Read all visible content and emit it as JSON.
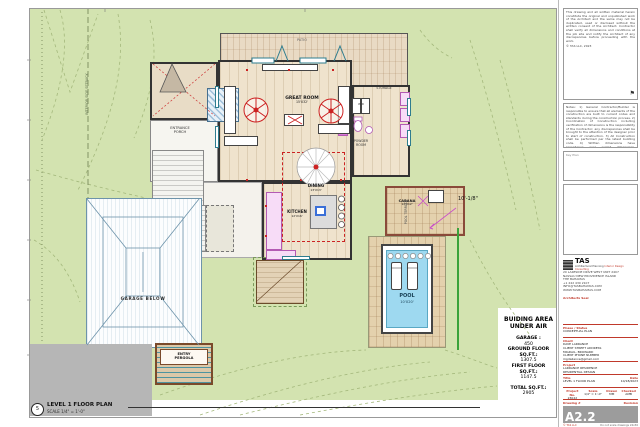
{
  "sheet_title": {
    "bubble": "5",
    "title": "LEVEL 1 FLOOR PLAN",
    "scale": "SCALE 1/4\" = 1'-0\""
  },
  "plan": {
    "patio": "PATIO",
    "great_room": "GREAT ROOM",
    "great_room_size": "15'X32'",
    "entrance_porch_1": "ENTRANCE",
    "entrance_porch_2": "PORCH",
    "dining": "DINING",
    "dining_size": "13'X13'",
    "kitchen": "KITCHEN",
    "kitchen_size": "12'X16'",
    "storage": "STORAGE",
    "wd": "W.D",
    "powder_1": "POWDER",
    "powder_2": "ROOM",
    "cabana": "CABANA",
    "cabana_size": "12'X12'",
    "pool_terrace": "POOL TERRACE",
    "pool": "POOL",
    "pool_size": "10'X20'",
    "garage_below": "GARAGE BELOW",
    "entry_pergola_1": "ENTRY",
    "entry_pergola_2": "PERGOLA",
    "setback": "INTERIOR SIDE SETBACK",
    "dim": "10'-1/8\""
  },
  "area_summary": {
    "title1": "BUIDING AREA",
    "title2": "UNDER AIR",
    "garage_label": "GARAGE :",
    "garage_value": "450",
    "ground_label": "GROUND FLOOR",
    "ground_sqft": "SQ.FT.:",
    "ground_value": "1307.5",
    "first_label": "FIRST FLOOR",
    "first_sqft": "SQ.FT.:",
    "first_value": "1147.5",
    "total_label": "TOTAL SQ.FT.:",
    "total_value": "2905"
  },
  "title_block": {
    "copyright": "This drawing and all written material herein constitute the original and unpublished work of the Architect and the same may not be duplicated, used or disclosed without the written consent of the Architect. Contractor shall verify all dimensions and conditions at the job site and notify the Architect of any discrepancies before proceeding with the work.",
    "copyright_sig": "© TAS LLC, 2023",
    "notes": "Notes:  1) General Contractor/Builder is responsible to ensure that all elements of the construction are built to current codes and standards during the construction process.  2) Coordination of Construction including verification of dimensions is the responsibility of the Contractor; any discrepancies shall be brought to the attention of the designer prior to start of construction.  3) All Construction shall be performed per the latest building code.  4) Written dimensions have precedence over scaled dimensions. Contractor shall verify and be responsible for all dimensions and conditions of the job.",
    "key_plan": "Key Plan",
    "logo": "TAS",
    "logo_sub1": "Architectural Planning",
    "logo_sub2": "Interior Design Consulting",
    "address": [
      "20 LAKESIDE DRIVE WEST UNIT 2407",
      "NASSAU NEW PROVIDENCE ISLAND",
      "THE BAHAMAS",
      "+1 242 430 2107",
      "INFO@TASBAHAMAS.COM",
      "WWW.TASBAHAMAS.COM"
    ],
    "seal": "Architects Seal",
    "phase_label": "Phase / Status",
    "phase_value": "CONCEPTUAL PLAN",
    "client_label": "Client",
    "client": [
      "DAVE LARRANCE",
      "CLIENT STREET ADDRESS",
      "MIGDAIL, BROWARD",
      "CLIENT PHONE NUMBER",
      "mgdailance@gmail.com"
    ],
    "project_label": "Project",
    "project": [
      "LARRANCE RESIDENCE",
      "RESIDENTIAL DESIGN"
    ],
    "title_label": "Title",
    "title_value": "LEVEL 1 FLOOR PLAN",
    "date_label": "Date",
    "date_value": "10/18/2023",
    "pno_label": "Project No.",
    "pno_value": "23022",
    "scale_label": "Scale",
    "scale_value": "1/4\" = 1'-0\"",
    "drawn_label": "Drawn",
    "drawn_value": "MM",
    "checked_label": "Checked",
    "checked_value": "AMB",
    "drawing_label": "Drawing #",
    "revision_label": "Revision",
    "sheet_number": "A2.2",
    "footer_left": "© TAS LLC",
    "footer_right": "Do not scale drawings 24x36"
  },
  "colors": {
    "accent_red": "#c0392b",
    "site_green": "#d3e3b0",
    "pool_blue": "#9ed9f0",
    "teal": "#2e7d8f",
    "magenta": "#c94fc9"
  }
}
